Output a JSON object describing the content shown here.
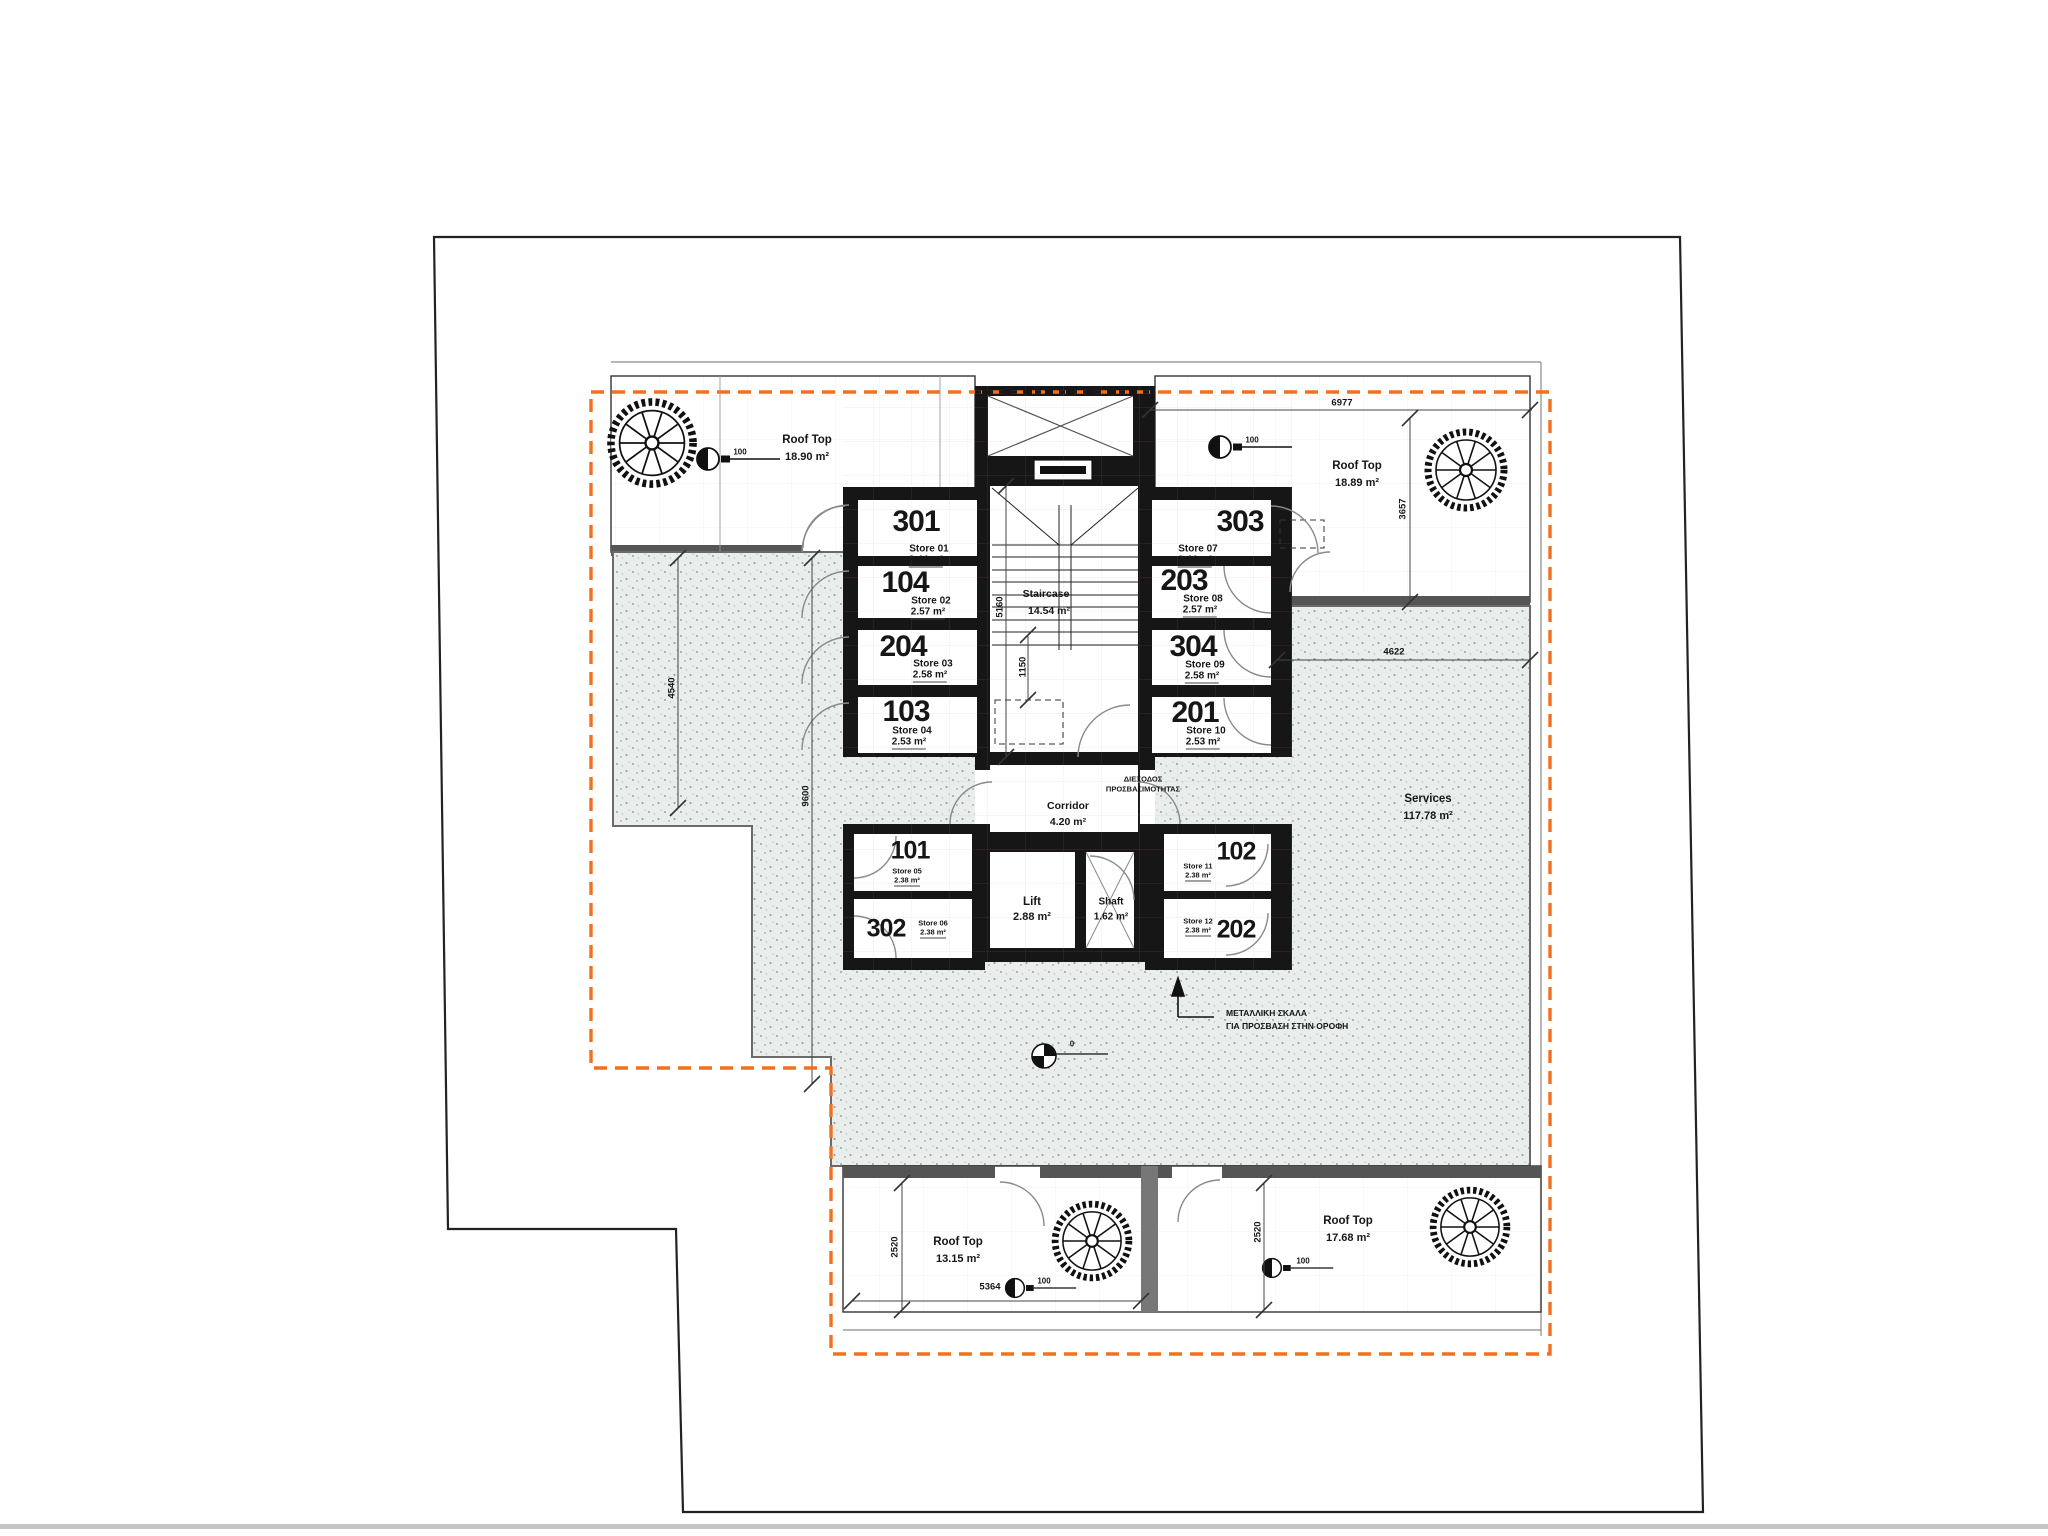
{
  "plan": {
    "colors": {
      "wall": "#161616",
      "stipple_fill": "#e9edeb",
      "stipple_dot": "#4f5b57",
      "site_boundary": "#f2701e",
      "property_line": "#222222",
      "dim_line": "#444444"
    },
    "rooms": {
      "rooftop_top_left": {
        "name": "Roof Top",
        "area": "18.90 m²"
      },
      "rooftop_top_right": {
        "name": "Roof Top",
        "area": "18.89 m²"
      },
      "rooftop_bottom_left": {
        "name": "Roof Top",
        "area": "13.15 m²"
      },
      "rooftop_bottom_right": {
        "name": "Roof Top",
        "area": "17.68 m²"
      },
      "services": {
        "name": "Services",
        "area": "117.78 m²"
      },
      "staircase": {
        "name": "Staircase",
        "area": "14.54 m²"
      },
      "corridor": {
        "name": "Corridor",
        "area": "4.20 m²"
      },
      "lift": {
        "name": "Lift",
        "area": "2.88 m²"
      },
      "shaft": {
        "name": "Shaft",
        "area": "1.62 m²"
      }
    },
    "stores": [
      {
        "unit": "301",
        "label": "Store 01",
        "area": "2.44 m²"
      },
      {
        "unit": "104",
        "label": "Store 02",
        "area": "2.57 m²"
      },
      {
        "unit": "204",
        "label": "Store 03",
        "area": "2.58 m²"
      },
      {
        "unit": "103",
        "label": "Store 04",
        "area": "2.53 m²"
      },
      {
        "unit": "303",
        "label": "Store 07",
        "area": "2.44 m²"
      },
      {
        "unit": "203",
        "label": "Store 08",
        "area": "2.57 m²"
      },
      {
        "unit": "304",
        "label": "Store 09",
        "area": "2.58 m²"
      },
      {
        "unit": "201",
        "label": "Store 10",
        "area": "2.53 m²"
      },
      {
        "unit": "101",
        "label": "Store 05",
        "area": "2.38 m²"
      },
      {
        "unit": "302",
        "label": "Store 06",
        "area": "2.38 m²"
      },
      {
        "unit": "102",
        "label": "Store 11",
        "area": "2.38 m²"
      },
      {
        "unit": "202",
        "label": "Store 12",
        "area": "2.38 m²"
      }
    ],
    "dimensions": {
      "top_width": "6977",
      "right_rooftop_depth": "3657",
      "services_width": "4622",
      "terrace_left_depth": "4540",
      "terrace_mid_depth": "9600",
      "staircase_depth": "5160",
      "stair_landing": "1150",
      "rooftop_bl_depth": "2520",
      "rooftop_bl_width": "5364",
      "rooftop_br_depth": "2520"
    },
    "markers": {
      "drain_label": "100",
      "benchmark_label": "0"
    },
    "annotations": {
      "access_note_line1": "ΔΙΕΞΟΔΟΣ",
      "access_note_line2": "ΠΡΟΣΒΑΣΙΜΟΤΗΤΑΣ",
      "metal_stair_line1": "ΜΕΤΑΛΛΙΚΗ ΣΚΑΛΑ",
      "metal_stair_line2": "ΓΙΑ ΠΡΟΣΒΑΣΗ ΣΤΗΝ ΟΡΟΦΗ"
    }
  }
}
